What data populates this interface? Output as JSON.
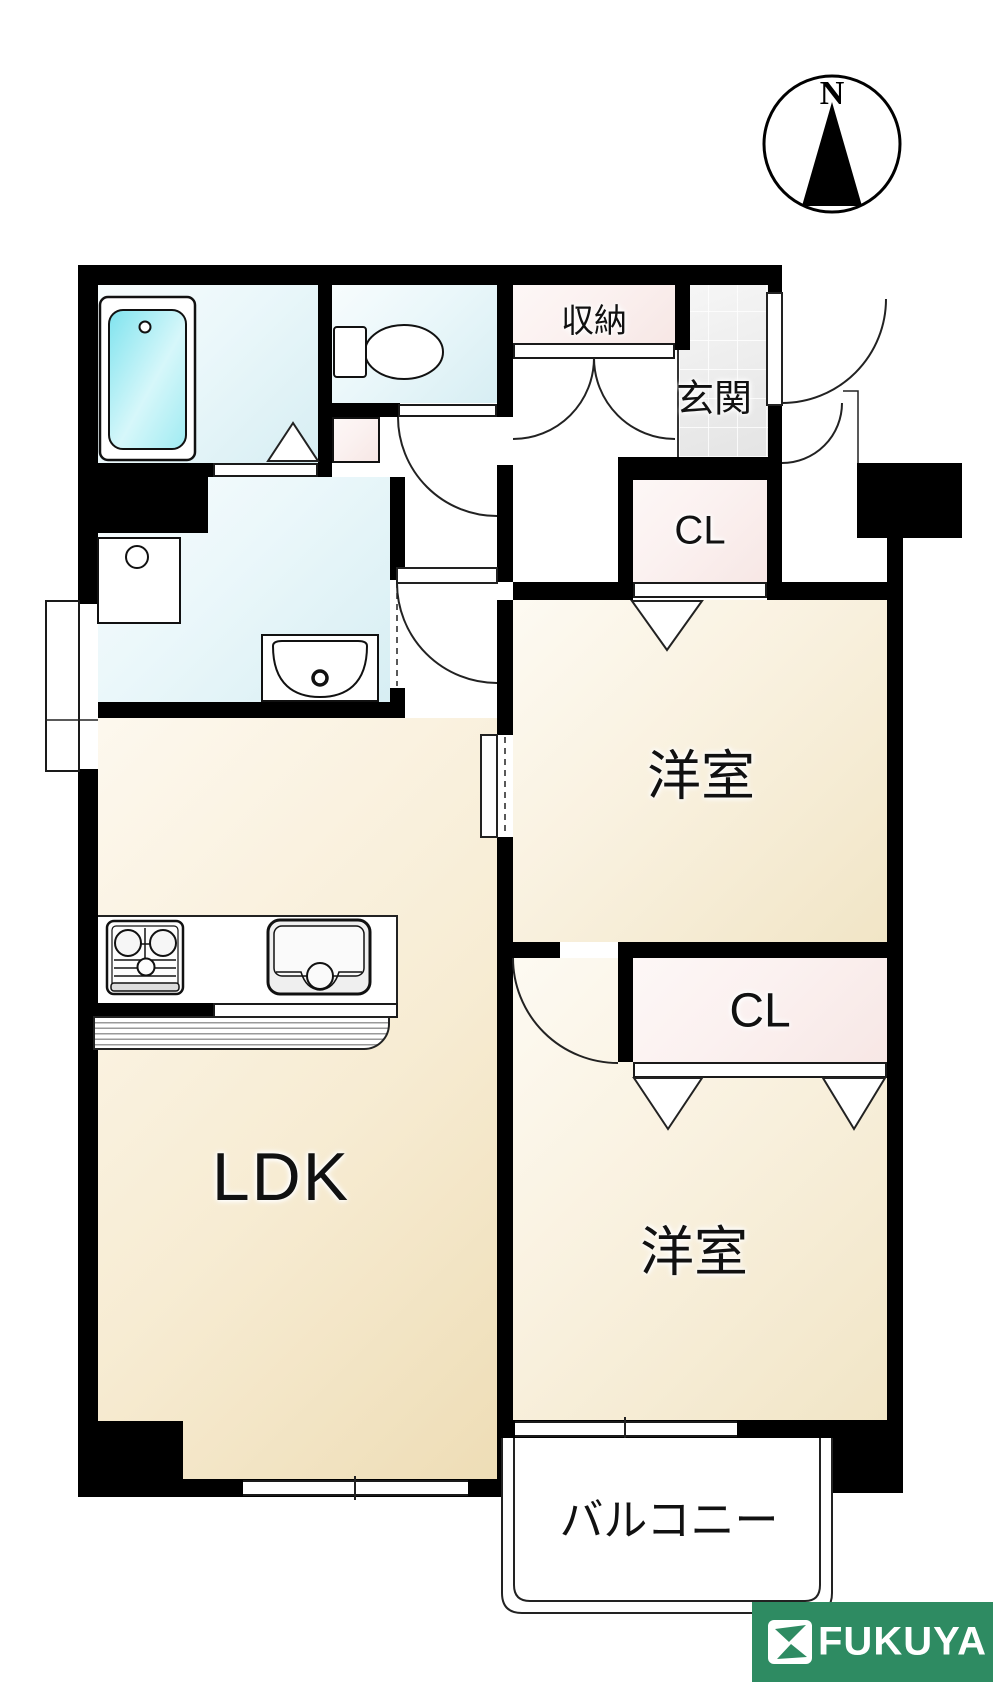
{
  "compass": {
    "north_label": "N"
  },
  "rooms": {
    "storage": {
      "label": "収納"
    },
    "entrance": {
      "label": "玄関"
    },
    "closet_upper": {
      "label": "CL"
    },
    "bedroom_upper": {
      "label": "洋室"
    },
    "closet_lower": {
      "label": "CL"
    },
    "bedroom_lower": {
      "label": "洋室"
    },
    "ldk": {
      "label": "LDK"
    },
    "balcony": {
      "label": "バルコニー"
    }
  },
  "logo": {
    "brand": "FUKUYA"
  },
  "colors": {
    "wall_black": "#000000",
    "floor_cream": "#f1e5c6",
    "floor_cyan": "#ddf1f5",
    "closet_pink": "#f8e9e7",
    "bathtub_cyan": "#86e4ee",
    "logo_green": "#2e8b62"
  }
}
